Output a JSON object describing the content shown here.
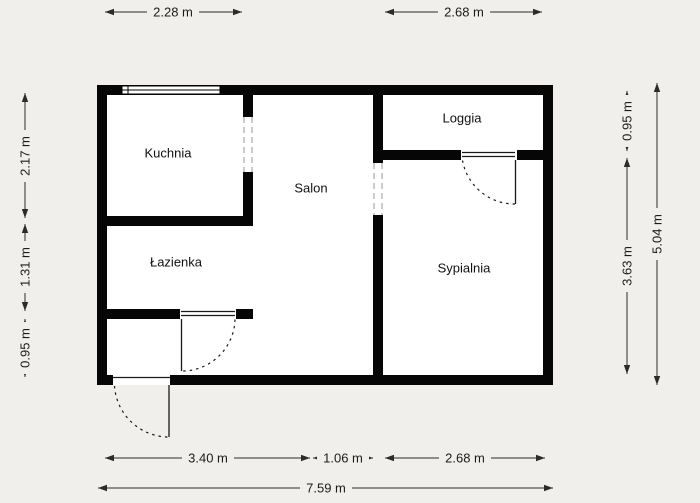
{
  "plan_title": "Apartment floor plan",
  "rooms": [
    {
      "id": "kuchnia",
      "name": "Kuchnia"
    },
    {
      "id": "salon",
      "name": "Salon"
    },
    {
      "id": "loggia",
      "name": "Loggia"
    },
    {
      "id": "lazienka",
      "name": "Łazienka"
    },
    {
      "id": "sypialnia",
      "name": "Sypialnia"
    }
  ],
  "dimensions": {
    "top": [
      {
        "label": "2.28 m"
      },
      {
        "label": "2.68 m"
      }
    ],
    "left": [
      {
        "label": "2.17 m"
      },
      {
        "label": "1.31 m"
      },
      {
        "label": "0.95 m"
      }
    ],
    "right": [
      {
        "label": "0.95 m"
      },
      {
        "label": "3.63 m"
      },
      {
        "label": "5.04 m"
      }
    ],
    "bottom": [
      {
        "label": "3.40 m"
      },
      {
        "label": "1.06 m"
      },
      {
        "label": "2.68 m"
      }
    ],
    "bottom_total": {
      "label": "7.59 m"
    }
  },
  "colors": {
    "background": "#f0efeb",
    "wall": "#060606",
    "room_fill": "#ffffff",
    "dimension_line": "#2b2b2b",
    "text": "#1c1c1c"
  }
}
